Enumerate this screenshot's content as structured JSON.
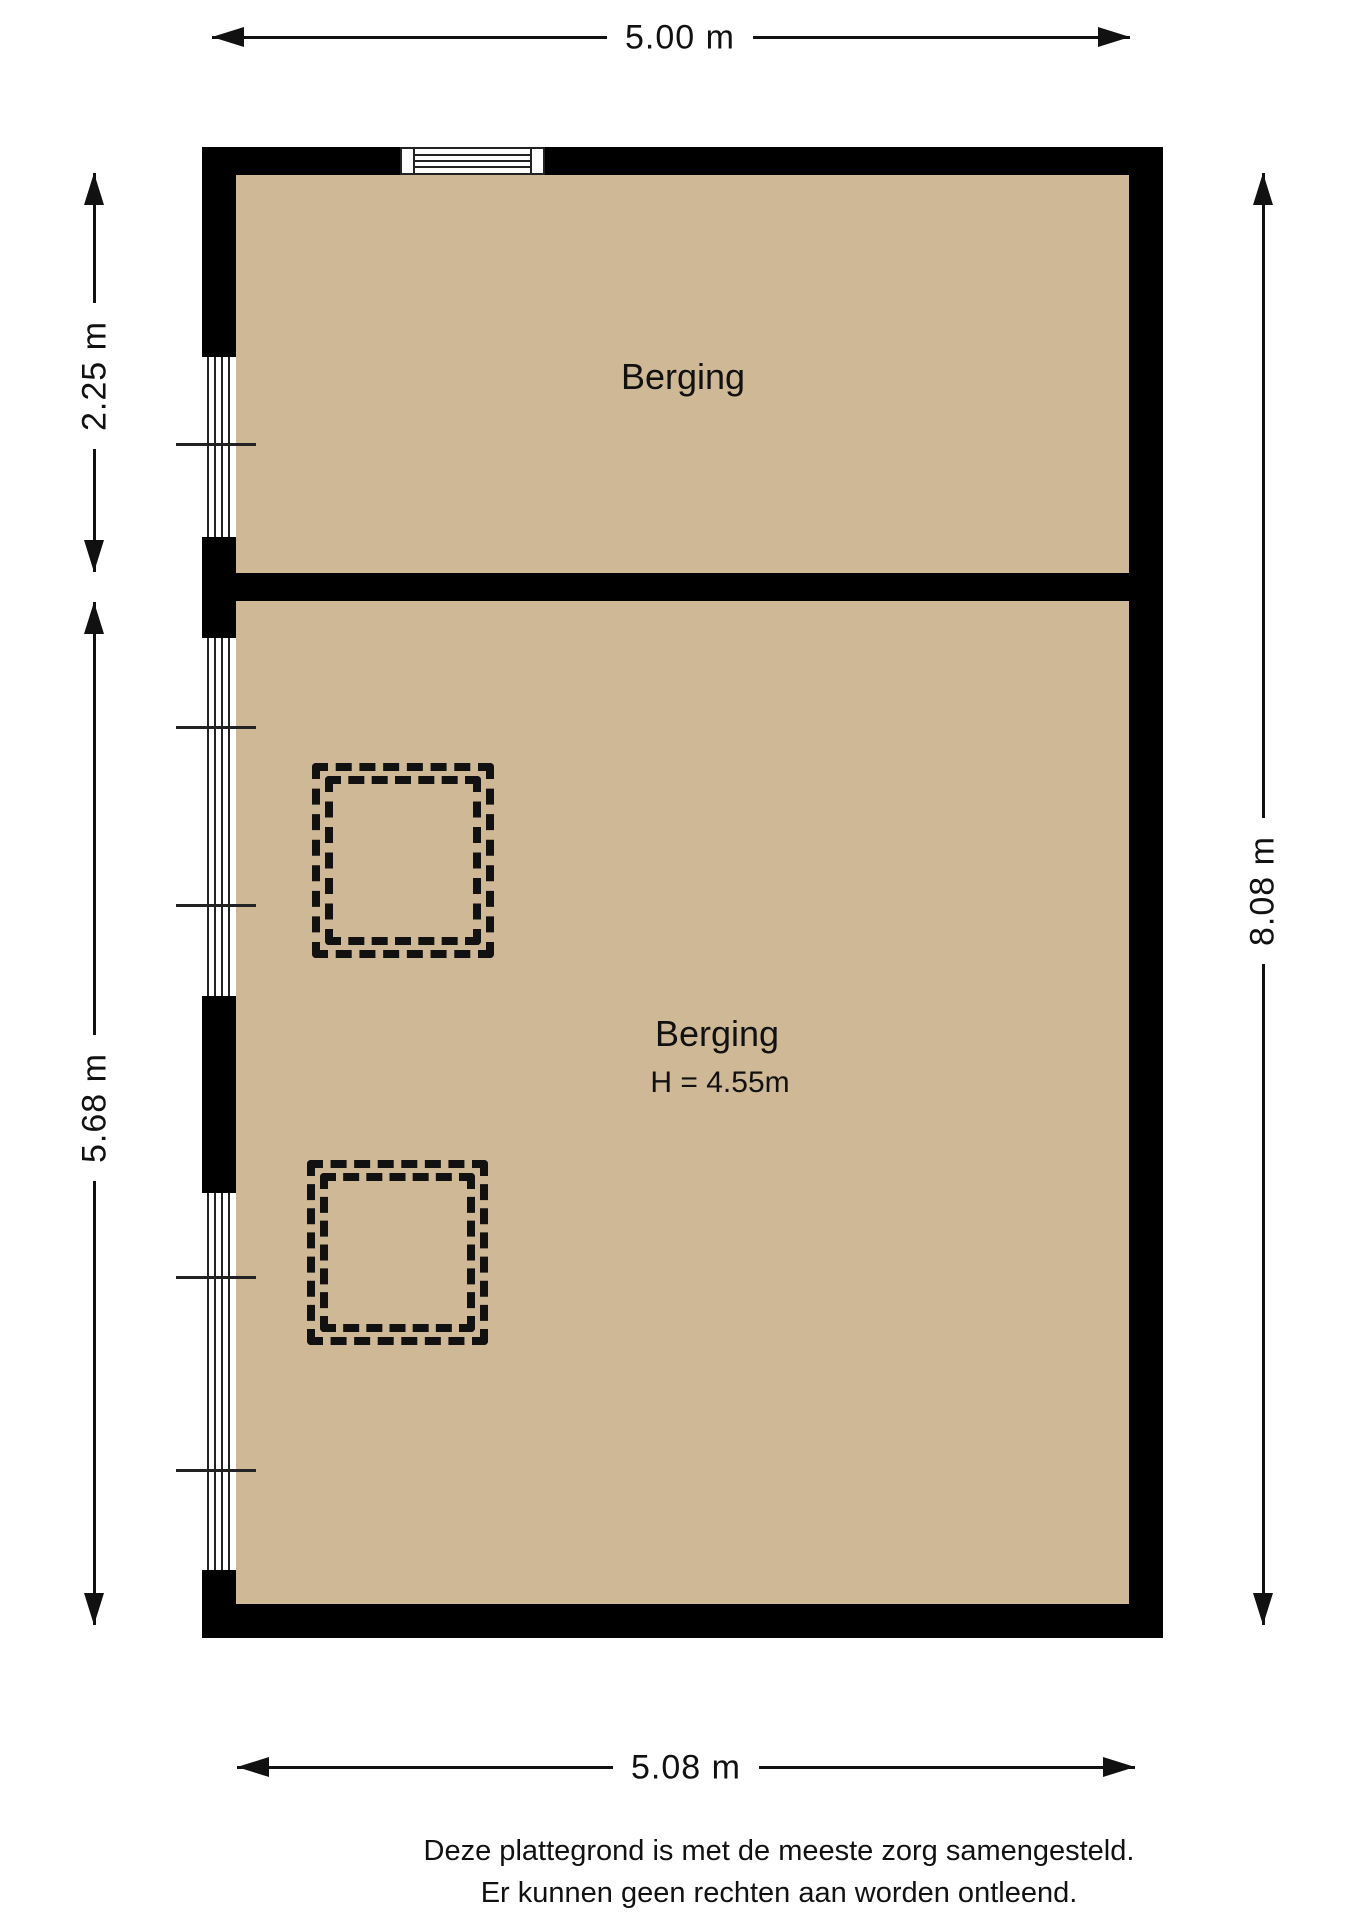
{
  "colors": {
    "floor": "#cfb896",
    "wall": "#000000",
    "line": "#111111",
    "background": "#ffffff"
  },
  "rooms": {
    "top": {
      "name": "Berging"
    },
    "bottom": {
      "name": "Berging",
      "height": "H = 4.55m"
    }
  },
  "dimensions": {
    "top": {
      "label": "5.00 m",
      "orientation": "horizontal"
    },
    "left_upper": {
      "label": "2.25 m",
      "orientation": "vertical"
    },
    "left_lower": {
      "label": "5.68 m",
      "orientation": "vertical"
    },
    "right": {
      "label": "8.08 m",
      "orientation": "vertical"
    },
    "bottom": {
      "label": "5.08 m",
      "orientation": "horizontal"
    }
  },
  "icons": {
    "dimension_arrow": "css-triangle",
    "window": "parallel-lines",
    "roof_opening": "double-dashed-square"
  },
  "disclaimer": {
    "line1": "Deze plattegrond is met de meeste zorg samengesteld.",
    "line2": "Er kunnen geen rechten aan worden ontleend."
  }
}
